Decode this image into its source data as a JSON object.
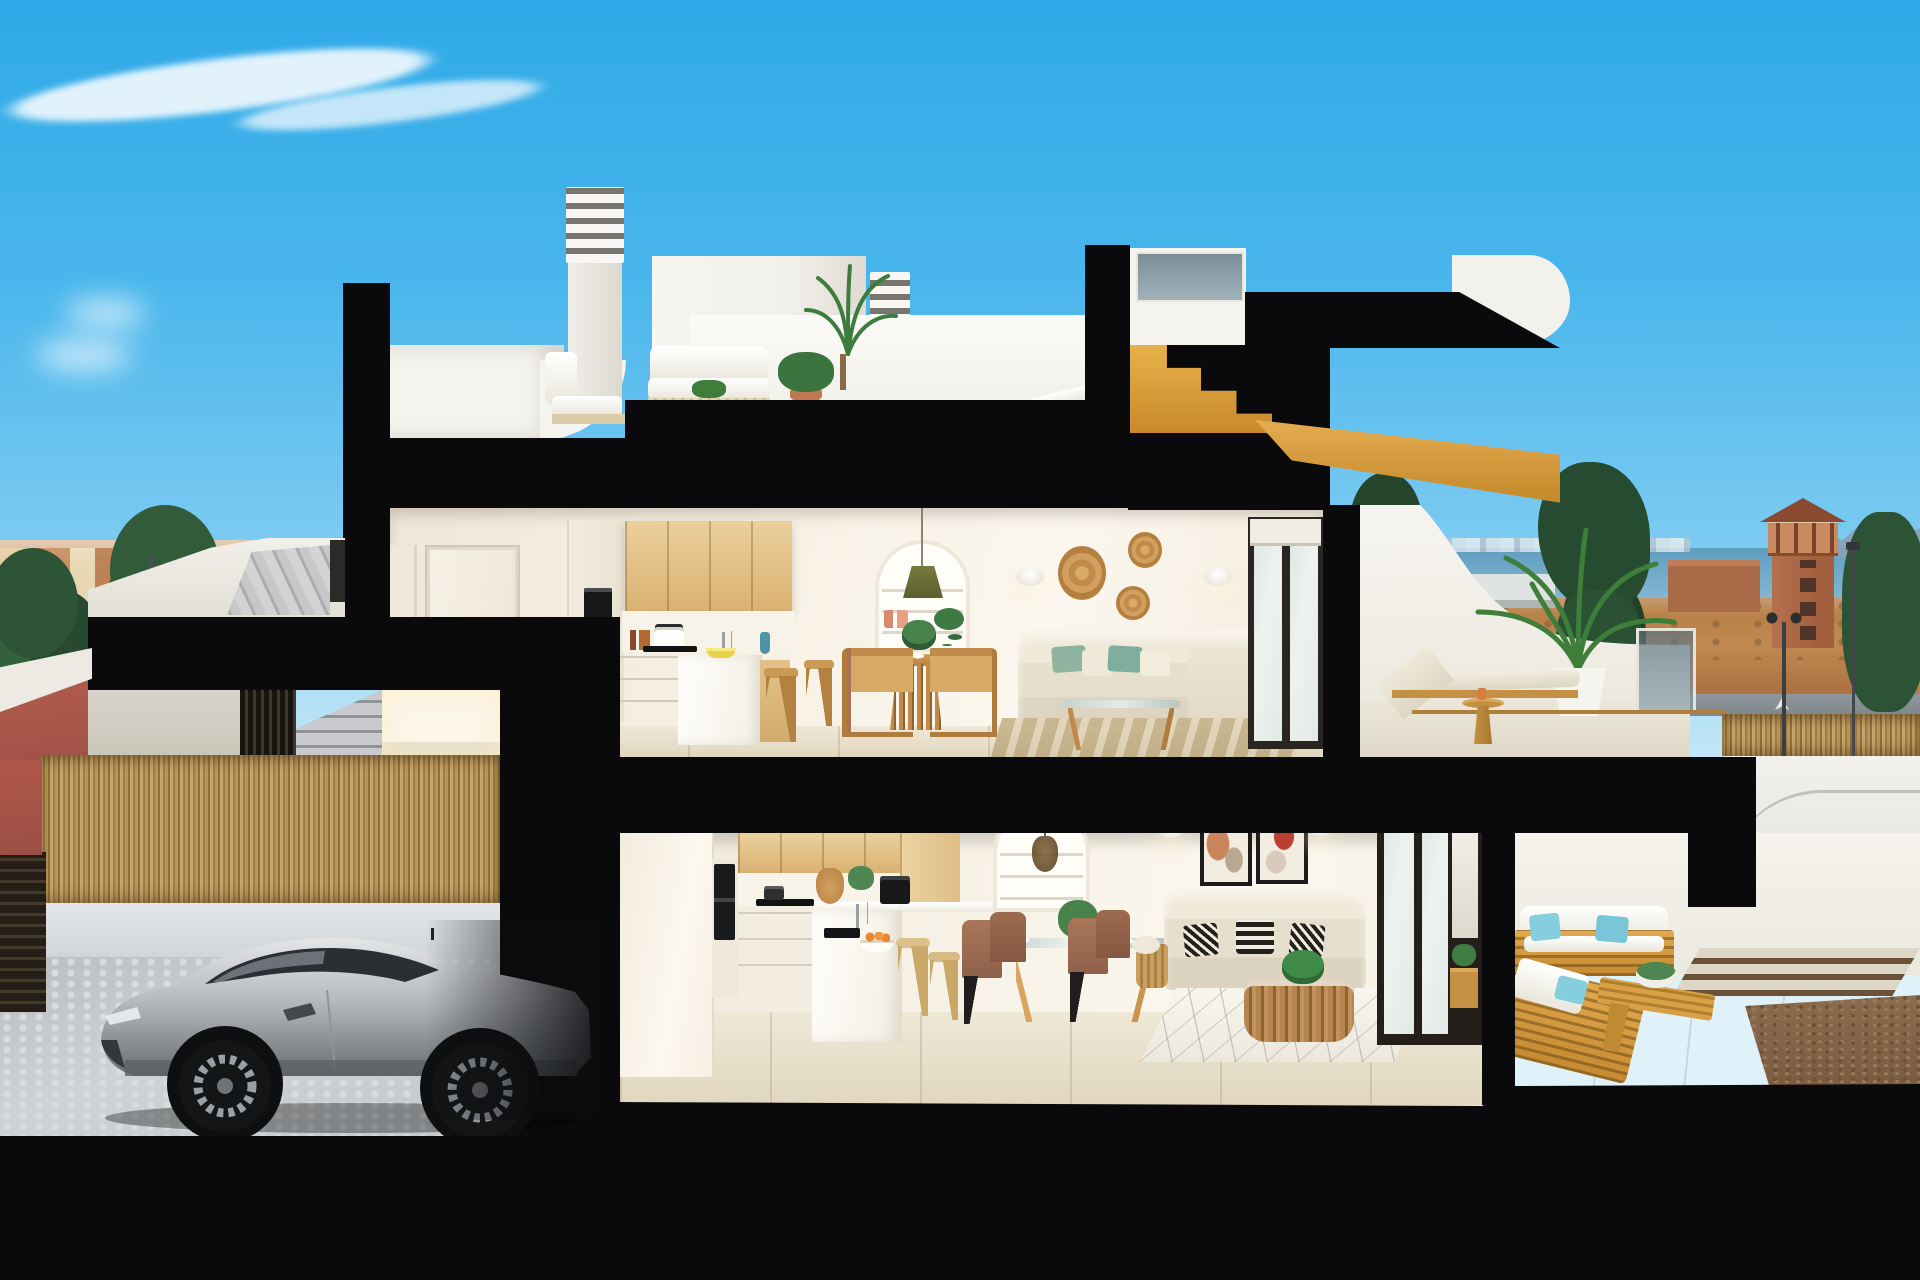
{
  "meta": {
    "title": "3D cutaway cross-section render of a two-storey coastal duplex",
    "media_type": "architectural-render",
    "canvas": "1920x1280",
    "no_visible_text": true
  },
  "palette": {
    "skyTop": "#2fa9e7",
    "ink": "#0a0a0c",
    "cream": "#f3ecdf",
    "woodCabinet": "#dfb97f",
    "teakOutdoor": "#d69b3f",
    "sofaCream": "#eae4d4",
    "pillowGreen": "#8fb5a0",
    "pillowTeal": "#7fc9d8",
    "seaBlue": "#6fa9c8",
    "brickTower": "#ad6b4a",
    "treeGreen": "#2d5436",
    "carSilver": "#b7babe",
    "redPavement": "#b65f4e",
    "gravelBrown": "#8c6c4e"
  },
  "scene": {
    "sky": {
      "clouds": 3
    },
    "background_left": {
      "items": [
        "terracotta-town-skyline",
        "green-trees",
        "street",
        "red-bike-lane",
        "street-lamp",
        "blue-sign"
      ]
    },
    "background_right": {
      "items": [
        "sea-horizon",
        "distant-mountains",
        "brick-watchtower",
        "cypress-trees",
        "brick-building",
        "white-sheds",
        "dirt-ground",
        "street-lamps",
        "bamboo-fence",
        "white-driveway-ramp"
      ]
    },
    "rooftop": {
      "items": [
        "louvered-chimney-tall",
        "louvered-chimney-short",
        "white-penthouse-block",
        "roof-terrace-back-wall",
        "white-lounge-chair",
        "white-outdoor-sofa",
        "outdoor-coffee-table",
        "potted-palm-small",
        "tall-palm-planter",
        "right-lounger",
        "glass-parapet",
        "wood-stair-soffit"
      ]
    },
    "upper_floor": {
      "kitchen": [
        "white-interior-door",
        "tall-cabinet-with-double-oven",
        "oak-upper-cabinets",
        "counter-with-pot-and-bottles",
        "induction-cooktop",
        "white-island",
        "chrome-faucet",
        "fruit-bowl",
        "blue-vase",
        "two-wood-stools"
      ],
      "dining": [
        "arched-shelf-niche",
        "olive-pendant-lamp",
        "coral-vases",
        "trailing-plant",
        "round-slatted-wood-table",
        "four-rattan-wood-chairs",
        "table-plates",
        "plant-centerpiece"
      ],
      "living": [
        "two-wall-sconces",
        "three-rattan-wall-plates",
        "cream-corner-sofa",
        "green-teal-pillows",
        "glass-coffee-table",
        "striped-jute-rug",
        "dark-framed-sliding-door"
      ],
      "terrace": [
        "curved-white-parapet",
        "teak-sun-lounger",
        "teak-side-table",
        "palm-in-white-pot",
        "glass-balustrade"
      ]
    },
    "lower_floor": {
      "entrance": [
        "white-stair-parapet",
        "exterior-steps",
        "dark-slatted-gate",
        "lit-entrance-hall"
      ],
      "kitchen": [
        "oak-upper-cabinets",
        "oven-column",
        "cooktop-run",
        "white-peninsula-with-sink",
        "bowl-of-oranges",
        "coffee-machine",
        "rattan-jug",
        "two-light-stools"
      ],
      "dining": [
        "arched-shelf-niche",
        "wire-pendant-lamp",
        "glass-table-wood-legs",
        "four-brown-chairs",
        "plates"
      ],
      "living": [
        "two-abstract-art-frames",
        "two-wall-sconces",
        "beige-sofa",
        "three-black-white-pillows",
        "rattan-basket-coffee-table",
        "side-basket-with-blanket",
        "diamond-pattern-rug",
        "dark-framed-sliding-doors"
      ],
      "terrace": [
        "two-teak-sofas-white-cushions",
        "light-blue-pillows",
        "teak-bench-table",
        "planter",
        "stone-paving",
        "timber-deck-strips",
        "gravel-bed"
      ]
    },
    "garage": {
      "items": [
        "bamboo-reed-fence",
        "low-white-wall",
        "cobblestone-drive",
        "dark-slatted-side-gate",
        "silver-sports-coupe"
      ]
    }
  }
}
